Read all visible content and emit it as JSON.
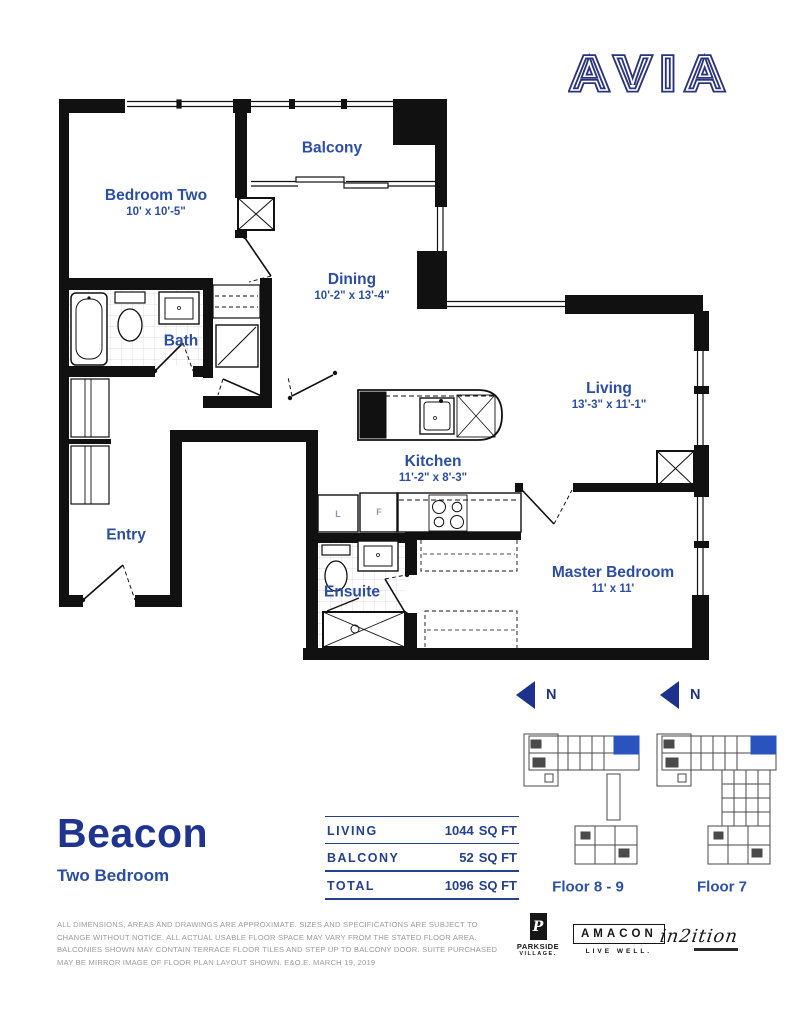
{
  "brand": {
    "logo": "AVIA"
  },
  "plan": {
    "rooms": {
      "bedroom_two": {
        "name": "Bedroom Two",
        "dims": "10' x 10'-5\""
      },
      "balcony": {
        "name": "Balcony"
      },
      "dining": {
        "name": "Dining",
        "dims": "10'-2\" x 13'-4\""
      },
      "bath": {
        "name": "Bath"
      },
      "living": {
        "name": "Living",
        "dims": "13'-3\" x 11'-1\""
      },
      "kitchen": {
        "name": "Kitchen",
        "dims": "11'-2\" x 8'-3\""
      },
      "entry": {
        "name": "Entry"
      },
      "ensuite": {
        "name": "Ensuite"
      },
      "master": {
        "name": "Master Bedroom",
        "dims": "11' x 11'"
      }
    },
    "fixtures": {
      "linen": "L",
      "fridge": "F"
    }
  },
  "unit": {
    "name": "Beacon",
    "type": "Two Bedroom"
  },
  "stats": {
    "rows": [
      {
        "label": "LIVING",
        "number": "1044",
        "unit": "SQ FT"
      },
      {
        "label": "BALCONY",
        "number": "52",
        "unit": "SQ FT"
      },
      {
        "label": "TOTAL",
        "number": "1096",
        "unit": "SQ FT"
      }
    ]
  },
  "locators": {
    "north": "N",
    "floor_a": "Floor 8 - 9",
    "floor_b": "Floor 7"
  },
  "disclaimer": "ALL DIMENSIONS, AREAS AND DRAWINGS ARE APPROXIMATE. SIZES AND SPECIFICATIONS ARE SUBJECT TO CHANGE WITHOUT NOTICE. ALL ACTUAL USABLE FLOOR SPACE MAY VARY FROM THE STATED FLOOR AREA. BALCONIES SHOWN MAY CONTAIN TERRACE FLOOR TILES AND STEP UP TO BALCONY DOOR. SUITE PURCHASED MAY BE MIRROR IMAGE OF FLOOR PLAN LAYOUT SHOWN. E&O.E. MARCH 19, 2019",
  "logos": {
    "parkside_glyph": "P",
    "parkside_line1": "PARKSIDE",
    "parkside_line2": "VILLAGE.",
    "amacon": "AMACON",
    "amacon_tagline": "LIVE WELL.",
    "in2ition": "in2ition"
  },
  "colors": {
    "label_blue": "#2b4da6",
    "heading_blue": "#1f3490",
    "arrow_blue": "#1e3a9e",
    "unit_highlight": "#2b53bd",
    "wall_black": "#111111"
  }
}
